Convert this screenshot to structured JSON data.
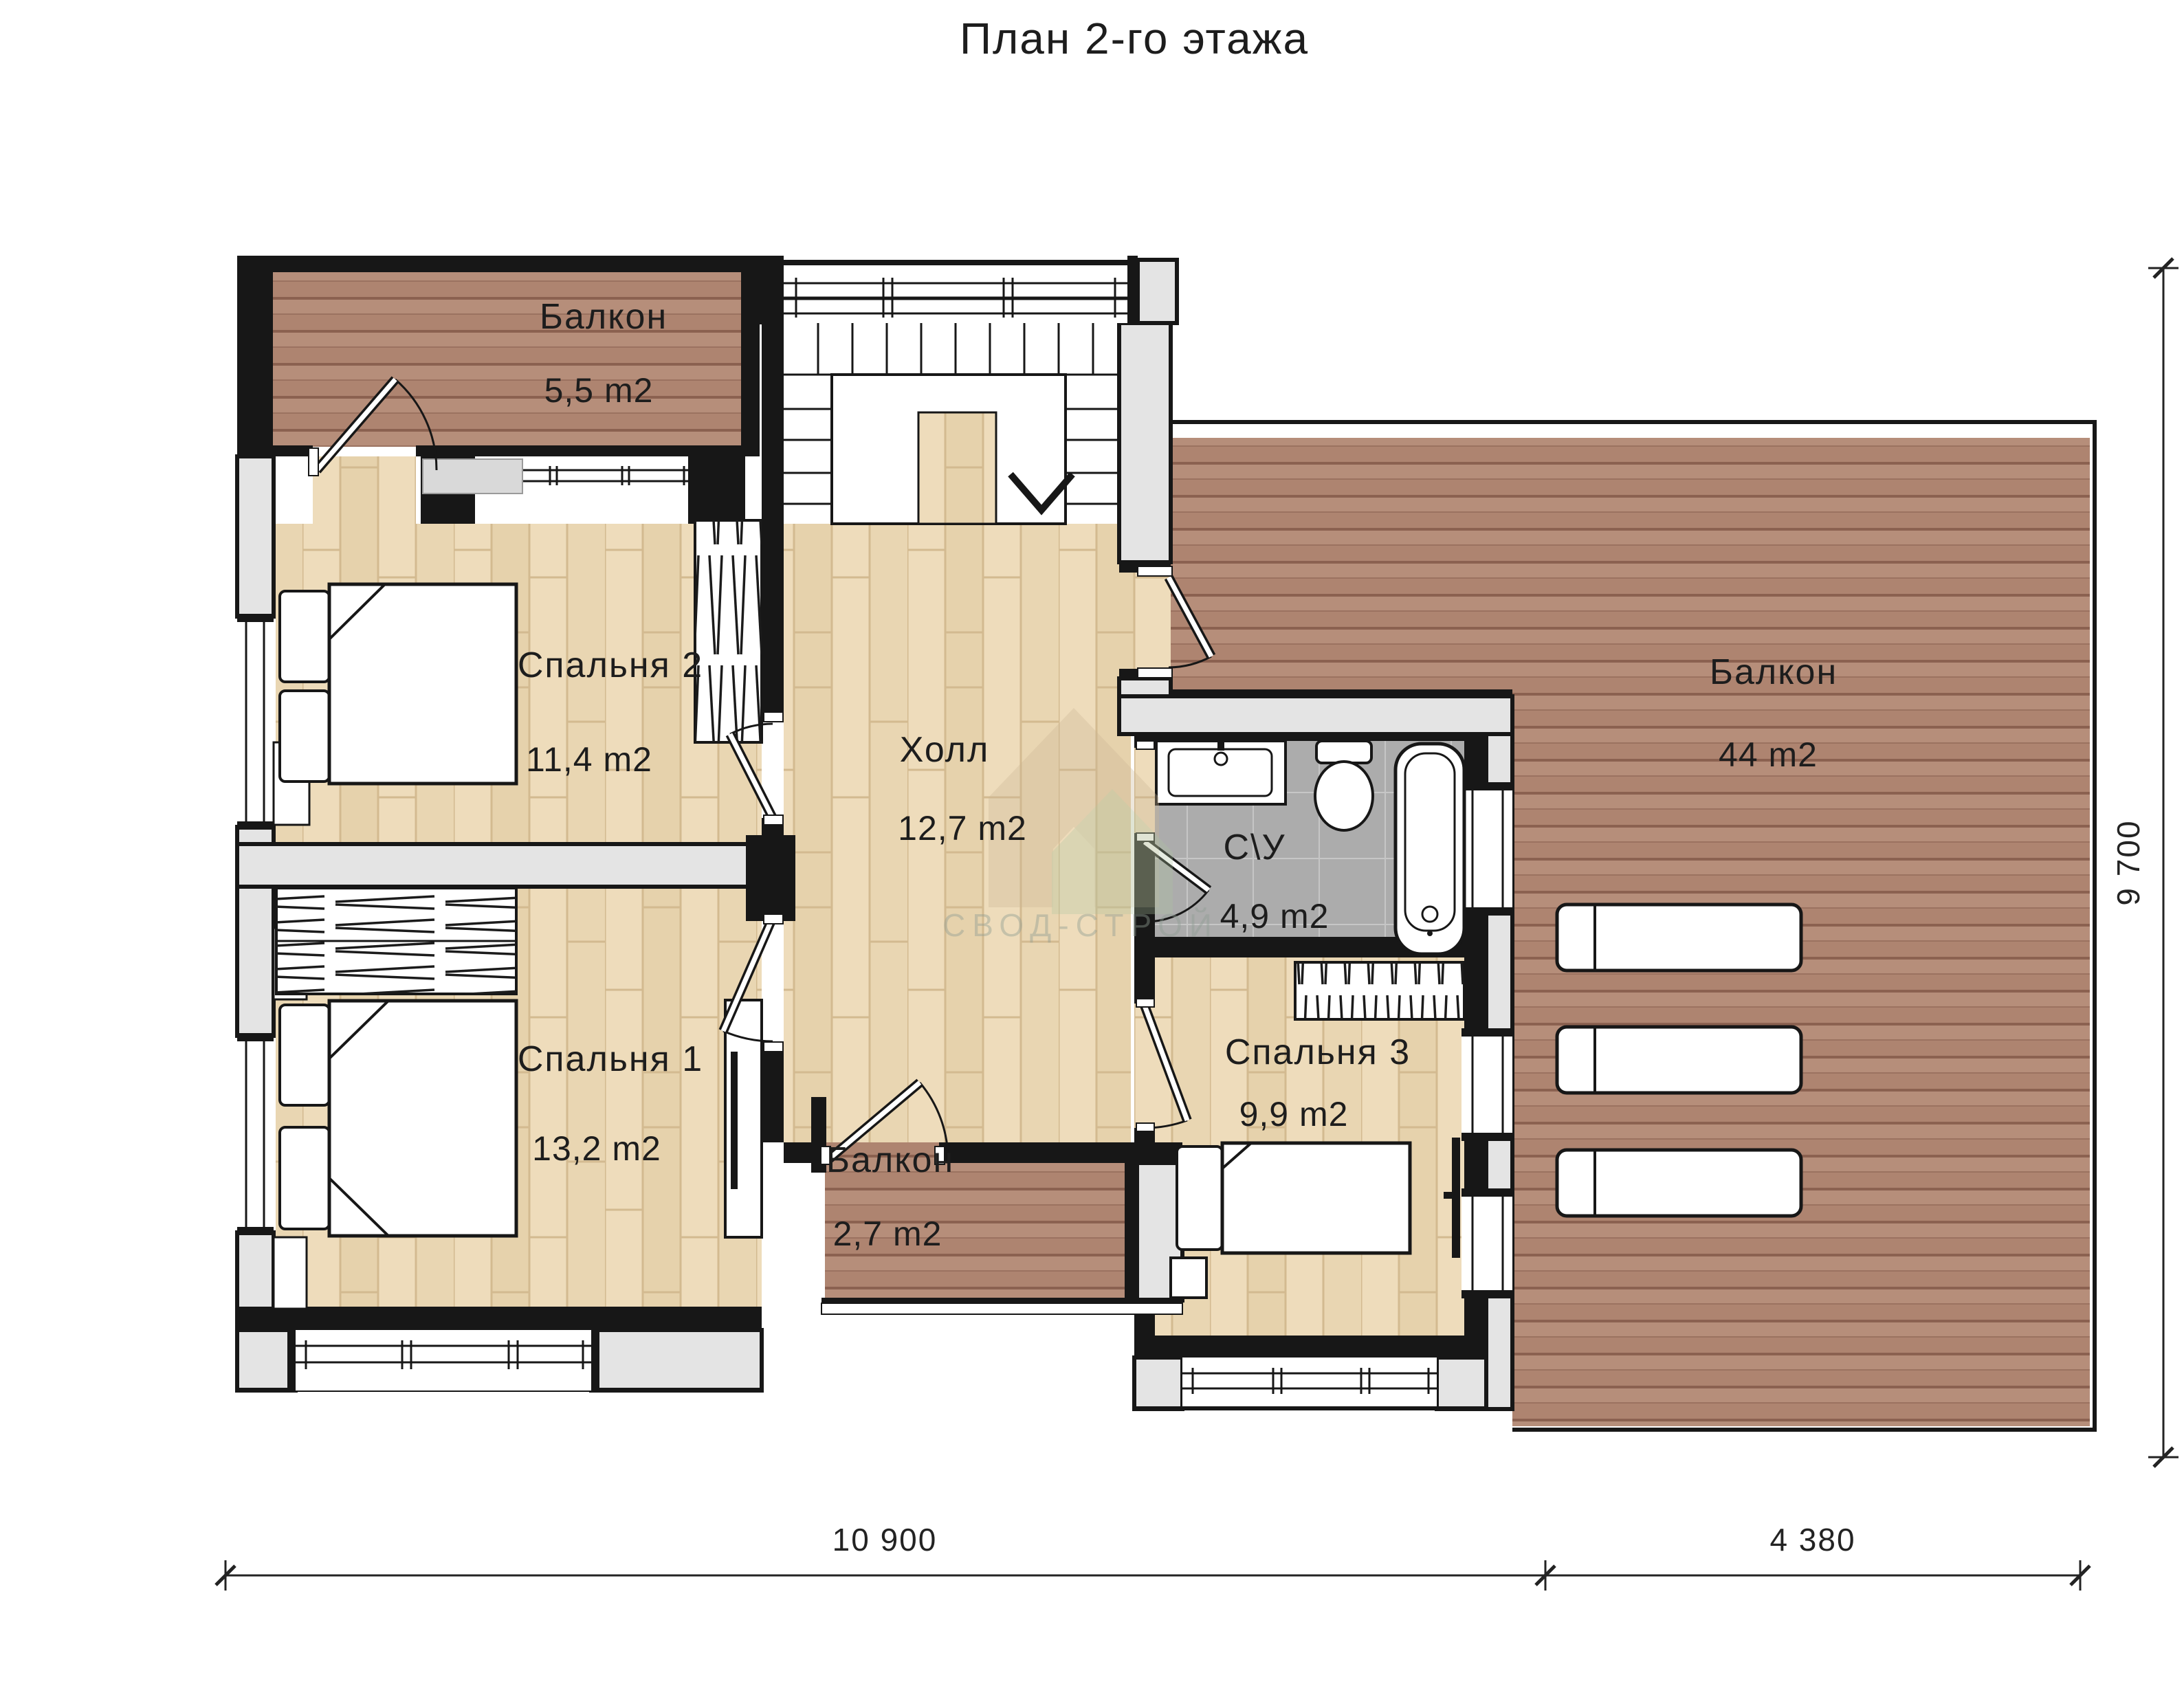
{
  "title": "План 2-го этажа",
  "watermark": "СВОД-СТРОЙ",
  "rooms": {
    "balcony_top": {
      "name": "Балкон",
      "area": "5,5 m2"
    },
    "bedroom2": {
      "name": "Спальня 2",
      "area": "11,4 m2"
    },
    "hall": {
      "name": "Холл",
      "area": "12,7 m2"
    },
    "bathroom": {
      "name": "С\\У",
      "area": "4,9 m2"
    },
    "balcony_right": {
      "name": "Балкон",
      "area": "44 m2"
    },
    "bedroom1": {
      "name": "Спальня 1",
      "area": "13,2 m2"
    },
    "balcony_small": {
      "name": "Балкон",
      "area": "2,7 m2"
    },
    "bedroom3": {
      "name": "Спальня 3",
      "area": "9,9 m2"
    }
  },
  "dimensions": {
    "bottom_main": "10 900",
    "bottom_right": "4 380",
    "side": "9 700"
  },
  "colors": {
    "wall": "#171717",
    "wood_floor": "#eedcbb",
    "deck": "#b68e7a",
    "tile": "#acacac",
    "exterior_wall_core": "#e4e4e4",
    "watermark_tan": "#c9b493",
    "watermark_green": "#adc4a0"
  }
}
